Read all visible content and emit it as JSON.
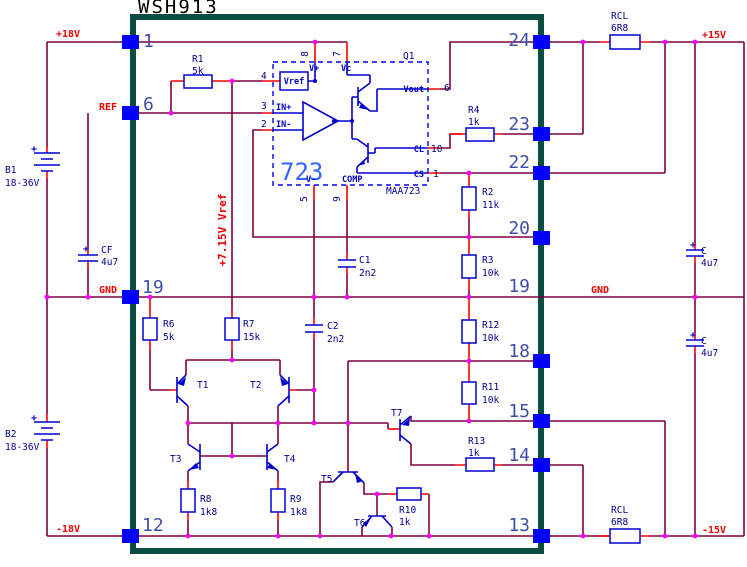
{
  "title": "WSH913",
  "colors": {
    "wire": "#800040",
    "lead": "#ff0000",
    "component_blue": "#0000cd",
    "module_border": "#0b4d40",
    "junction": "#ff00ff",
    "pin_square": "#0000ff",
    "label_red": "#ee0000",
    "pin_number_blue": "#3f4fa8",
    "ic_light_blue": "#3366ff"
  },
  "rails": {
    "p18": "+18V",
    "ref": "REF",
    "gnd_left": "GND",
    "m18": "-18V",
    "p15": "+15V",
    "gnd_right": "GND",
    "m15": "-15V",
    "vref_rail": "+7.15V Vref"
  },
  "module_pins": {
    "left": [
      "1",
      "6",
      "19",
      "12"
    ],
    "right": [
      "24",
      "23",
      "22",
      "20",
      "19",
      "18",
      "15",
      "14",
      "13"
    ]
  },
  "regulator": {
    "name": "723",
    "part": "MAA723",
    "designator": "Q1",
    "vref_box": "Vref",
    "pins": [
      {
        "num": "8",
        "name": "V+"
      },
      {
        "num": "7",
        "name": "Vc"
      },
      {
        "num": "4",
        "name": ""
      },
      {
        "num": "3",
        "name": "IN+"
      },
      {
        "num": "2",
        "name": "IN-"
      },
      {
        "num": "5",
        "name": "V-"
      },
      {
        "num": "9",
        "name": "COMP"
      },
      {
        "num": "6",
        "name": "Vout"
      },
      {
        "num": "10",
        "name": "CL"
      },
      {
        "num": "1",
        "name": "CS"
      }
    ]
  },
  "components": {
    "r1": {
      "ref": "R1",
      "value": "5k"
    },
    "r2": {
      "ref": "R2",
      "value": "11k"
    },
    "r3": {
      "ref": "R3",
      "value": "10k"
    },
    "r4": {
      "ref": "R4",
      "value": "1k"
    },
    "r6": {
      "ref": "R6",
      "value": "5k"
    },
    "r7": {
      "ref": "R7",
      "value": "15k"
    },
    "r8": {
      "ref": "R8",
      "value": "1k8"
    },
    "r9": {
      "ref": "R9",
      "value": "1k8"
    },
    "r10": {
      "ref": "R10",
      "value": "1k"
    },
    "r11": {
      "ref": "R11",
      "value": "10k"
    },
    "r12": {
      "ref": "R12",
      "value": "10k"
    },
    "r13": {
      "ref": "R13",
      "value": "1k"
    },
    "rcl_top": {
      "ref": "RCL",
      "value": "6R8"
    },
    "rcl_bot": {
      "ref": "RCL",
      "value": "6R8"
    },
    "c1": {
      "ref": "C1",
      "value": "2n2"
    },
    "c2": {
      "ref": "C2",
      "value": "2n2"
    },
    "cf": {
      "ref": "CF",
      "value": "4u7",
      "polarity": "+"
    },
    "c_top": {
      "ref": "C",
      "value": "4u7",
      "polarity": "+"
    },
    "c_bot": {
      "ref": "C",
      "value": "4u7",
      "polarity": "+"
    },
    "b1": {
      "ref": "B1",
      "value": "18-36V",
      "polarity": "+"
    },
    "b2": {
      "ref": "B2",
      "value": "18-36V",
      "polarity": "+"
    },
    "t1": {
      "ref": "T1"
    },
    "t2": {
      "ref": "T2"
    },
    "t3": {
      "ref": "T3"
    },
    "t4": {
      "ref": "T4"
    },
    "t5": {
      "ref": "T5"
    },
    "t6": {
      "ref": "T6"
    },
    "t7": {
      "ref": "T7"
    }
  }
}
